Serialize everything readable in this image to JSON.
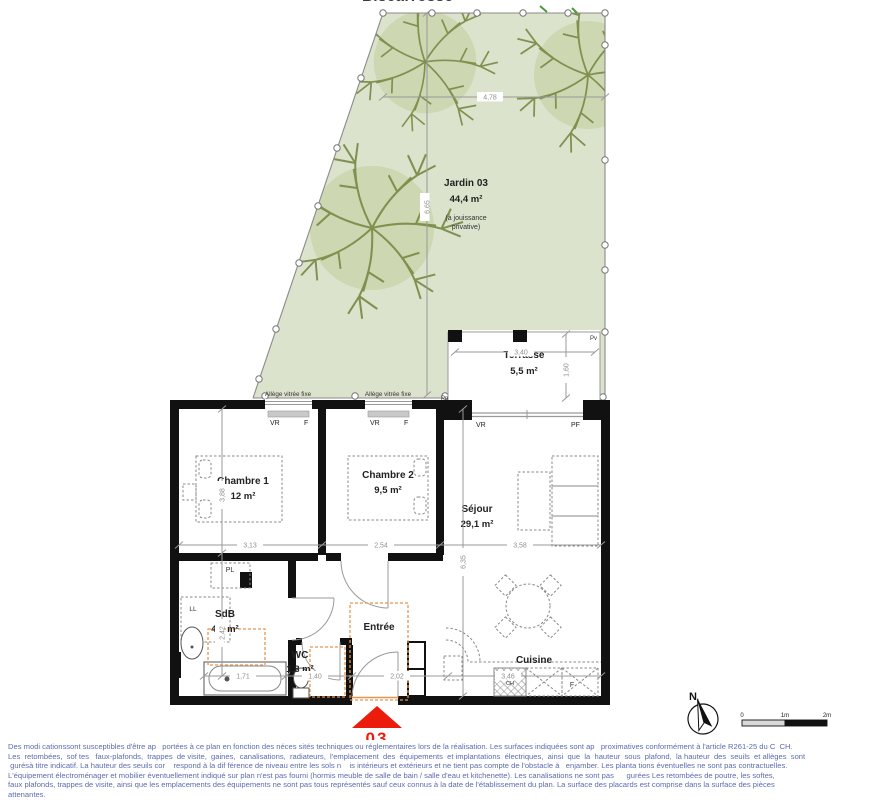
{
  "title": "Biscarrosse",
  "garden": {
    "name": "Jardin 03",
    "area": "44,4 m²",
    "note_line1": "(à jouissance",
    "note_line2": "privative)",
    "dim_width": "4,78",
    "dim_height": "6,65"
  },
  "terrace": {
    "name": "Terrasse",
    "area": "5,5 m²",
    "dim_width": "3,40",
    "dim_height": "1,60",
    "pv": "Pv",
    "pp": "Pp"
  },
  "windows": {
    "allege": "Allège vitrée fixe",
    "shutter": "VR",
    "fixed": "F",
    "french": "PF"
  },
  "rooms": {
    "chambre1": {
      "name": "Chambre 1",
      "area": "12 m²",
      "dim_w": "3,13",
      "dim_h": "3,88"
    },
    "chambre2": {
      "name": "Chambre 2",
      "area": "9,5 m²",
      "dim_w": "2,54"
    },
    "sejour": {
      "name": "Séjour",
      "area": "29,1 m²",
      "dim_w": "3,58",
      "dim_h": "6,35"
    },
    "sdb": {
      "name": "SdB",
      "area": "4,9 m²",
      "dim_h": "2,42",
      "dim_w": "1,71",
      "washer": "LL",
      "closet": "PL"
    },
    "wc": {
      "name": "WC",
      "area": "1,8 m²",
      "dim_w": "1,40"
    },
    "entree": {
      "name": "Entrée",
      "dim_w": "2,02"
    },
    "cuisine": {
      "name": "Cuisine",
      "dim_w": "3,46",
      "fridge": "F",
      "heater": "CH"
    }
  },
  "marker": {
    "number": "03"
  },
  "compass": {
    "north": "N"
  },
  "scale_bar": {
    "zero": "0",
    "one": "1m",
    "two": "2m"
  },
  "disclaimer": {
    "lines": [
      "Des modi cationssont susceptibles d'être ap   portées à ce plan en fonction des néces sités techniques ou réglementaires lors de la réalisation. Les surfaces indiquées sont ap   proximatives conformément à l'article R261-25 du C  CH.",
      "Les  retombées,  sof tes   faux-plafonds,  trappes  de visite,  gaines,  canalisations,  radiateurs,  l'emplacement  des  équipements  et implantations  électriques,  ainsi  que  la  hauteur  sous  plafond,  la hauteur  des  seuils  et allèges  sont",
      " gurésà titre indicatif. La hauteur des seuils cor    respond à la dif férence de niveau entre les sols n    is intérieurs et extérieurs et ne tient pas compte de l'obstacle à   enjamber. Les planta tions éventuelles ne sont pas contractuelles.",
      "L'équipement électroménager et mobilier éventuellement indiqué sur plan n'est pas fourni (hormis meuble de salle de bain / salle d'eau et kitchenette). Les canalisations ne sont pas      gurées Les retombées de poutre, les softes,",
      "faux plafonds, trappes de visite, ainsi que les emplacements des équipements ne sont pas tous représentés sauf ceux connus à la date de l'établissement du plan. La surface des placards est comprise dans la surface des pièces",
      "attenantes."
    ]
  },
  "colors": {
    "garden_fill": "#dce3cc",
    "tree_fill": "#cdd7b2",
    "tree_stroke": "#7f914f",
    "wall": "#111111",
    "fence": "#8a8a8a",
    "dimension": "#8f8f8f",
    "accent_orange": "#e8954f",
    "marker_red": "#ec1c0c",
    "disclaimer_text": "#5c6cb0"
  }
}
